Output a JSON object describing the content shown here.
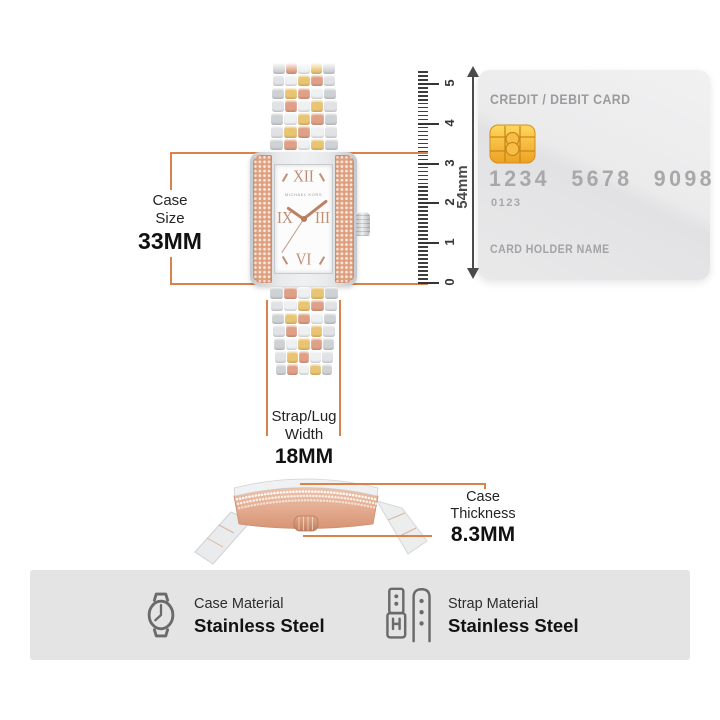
{
  "watch": {
    "brand": "MICHAEL KORS",
    "numerals": {
      "top": "XII",
      "right": "III",
      "bottom": "VI",
      "left": "IX"
    }
  },
  "measurements": {
    "case_size": {
      "label1": "Case",
      "label2": "Size",
      "value": "33MM"
    },
    "strap_width": {
      "label1": "Strap/Lug",
      "label2": "Width",
      "value": "18MM"
    },
    "case_thickness": {
      "label": "Case Thickness",
      "value": "8.3MM"
    }
  },
  "ruler": {
    "unit_labels": [
      "0",
      "1",
      "2",
      "3",
      "4",
      "5"
    ],
    "arrow_label": "54mm"
  },
  "card": {
    "title": "CREDIT / DEBIT CARD",
    "number_groups": [
      "1234",
      "5678",
      "9098"
    ],
    "sub_number": "0123",
    "holder_label": "CARD HOLDER NAME"
  },
  "materials": [
    {
      "icon": "watch-case-icon",
      "label": "Case Material",
      "value": "Stainless Steel"
    },
    {
      "icon": "strap-icon",
      "label": "Strap Material",
      "value": "Stainless Steel"
    }
  ],
  "colors": {
    "accent": "#d9834b",
    "silver": "#cfd2d5",
    "silver_light": "#eef0f1",
    "gold": "#e9c472",
    "rose_gold": "#e0a087",
    "card_bg": "#eaeaec",
    "chip_gold": "#f3b340",
    "band_bg": "#e4e4e4",
    "icon_gray": "#6a6a6a"
  }
}
